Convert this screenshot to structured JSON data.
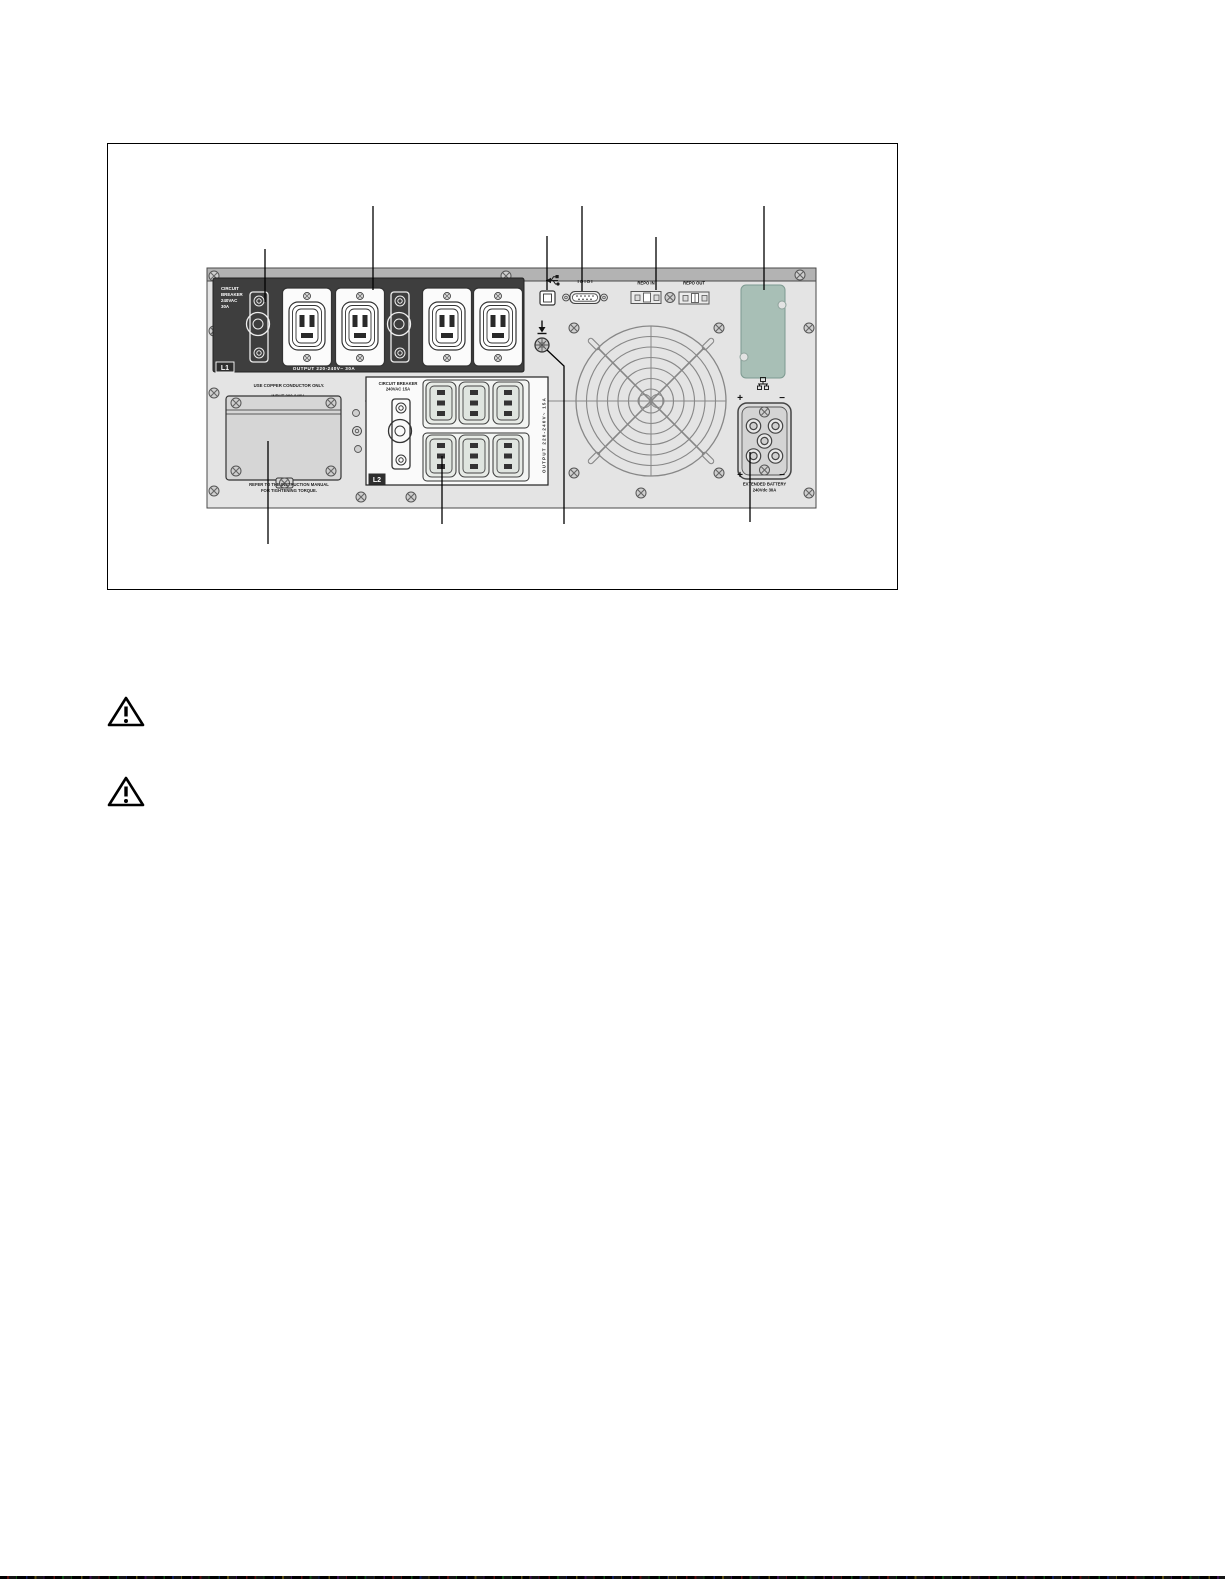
{
  "figure": {
    "description": "UPS rear panel diagram",
    "l1_section": {
      "breaker_label_lines": [
        "CIRCUIT",
        "BREAKER",
        "240VAC",
        "30A"
      ],
      "badge": "L1",
      "output_label": "OUTPUT 220-240V~ 30A"
    },
    "l2_section": {
      "breaker_label_lines": [
        "CIRCUIT BREAKER",
        "240VAC 15A"
      ],
      "badge": "L2",
      "output_label_vertical": "OUTPUT 220-240V~ 15A"
    },
    "comm_section": {
      "serial_label": "IOIOI",
      "repo_in_label": "REPO IN",
      "repo_out_label": "REPO OUT"
    },
    "input_section": {
      "warning_label": "USE COPPER CONDUCTOR ONLY.",
      "input_label": "INPUT 200-240V~",
      "note_lines": [
        "REFER TO THE INSTRUCTION MANUAL",
        "FOR TIGHTENING TORQUE."
      ]
    },
    "battery_section": {
      "label_lines": [
        "EXTENDED BATTERY",
        "240Vdc 30A"
      ],
      "plus": "+",
      "minus": "−"
    },
    "colors": {
      "panel": "#e4e4e4",
      "panel_top_bar": "#b3b3b3",
      "dark_outlet_panel": "#3e3e3e",
      "card_slot": "#a8bfb6",
      "line": "#000000"
    }
  },
  "warning_icons": [
    "warning-triangle",
    "warning-triangle"
  ]
}
